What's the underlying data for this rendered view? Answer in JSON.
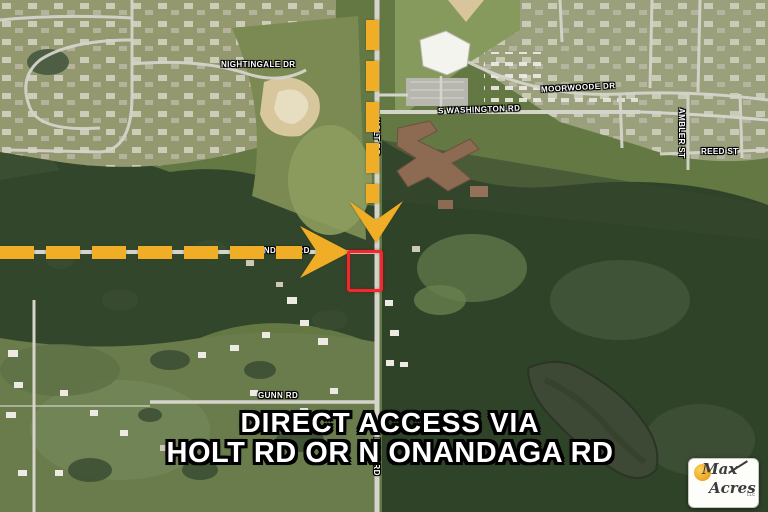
{
  "colors": {
    "arrow_yellow": "#EFAE26",
    "parcel_red": "#F2282E",
    "caption_white": "#FFFFFF"
  },
  "streets": {
    "nightingale": "NIGHTINGALE DR",
    "washington": "S WASHINGTON RD",
    "moorwoode": "MOORWOODE DR",
    "ambler": "AMBLER ST",
    "reed": "REED ST",
    "gunn": "GUNN RD",
    "holt_top": "HOLT RD",
    "holt_bottom": "HOLT RD",
    "onandaga": "N ONANDAGA RD"
  },
  "caption": {
    "line1": "DIRECT ACCESS VIA",
    "line2": "HOLT RD OR N ONANDAGA RD"
  },
  "logo": {
    "word1": "Max",
    "word2": "Acres",
    "suffix": "LLC"
  }
}
